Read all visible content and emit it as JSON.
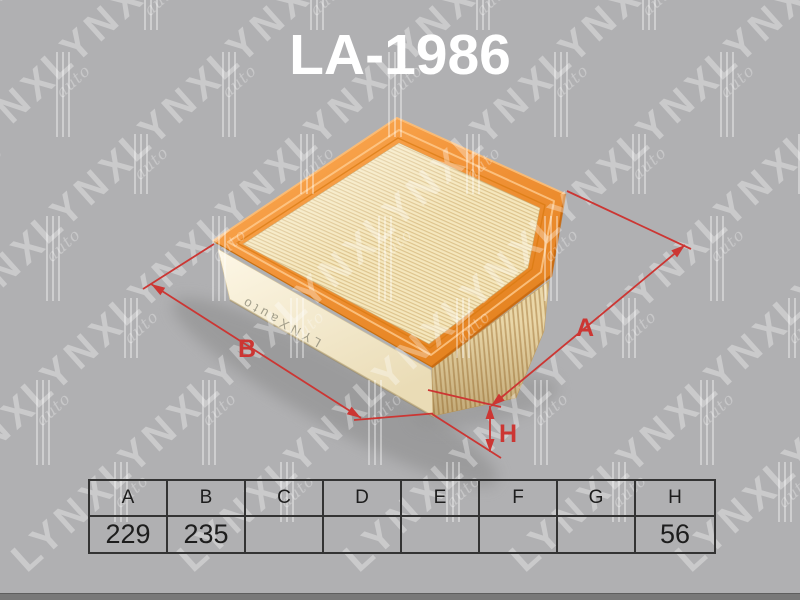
{
  "title": "LA-1986",
  "watermark": {
    "text": "LYNX",
    "sub": "auto"
  },
  "product": {
    "type_label": "air-filter",
    "side_print": "LYNXauto",
    "frame_color": "#EF8C2B",
    "media_color": "#F5E7BD",
    "base_color": "#FAF2DC"
  },
  "dimensions": {
    "a_label": "A",
    "b_label": "B",
    "h_label": "H",
    "line_color": "#CC3633"
  },
  "spec_table": {
    "headers": [
      "A",
      "B",
      "C",
      "D",
      "E",
      "F",
      "G",
      "H"
    ],
    "values": [
      "229",
      "235",
      "",
      "",
      "",
      "",
      "",
      "56"
    ]
  },
  "page": {
    "background": "#B0B0B2",
    "bottom_bar_color": "#787878",
    "title_color": "#FFFFFF"
  }
}
